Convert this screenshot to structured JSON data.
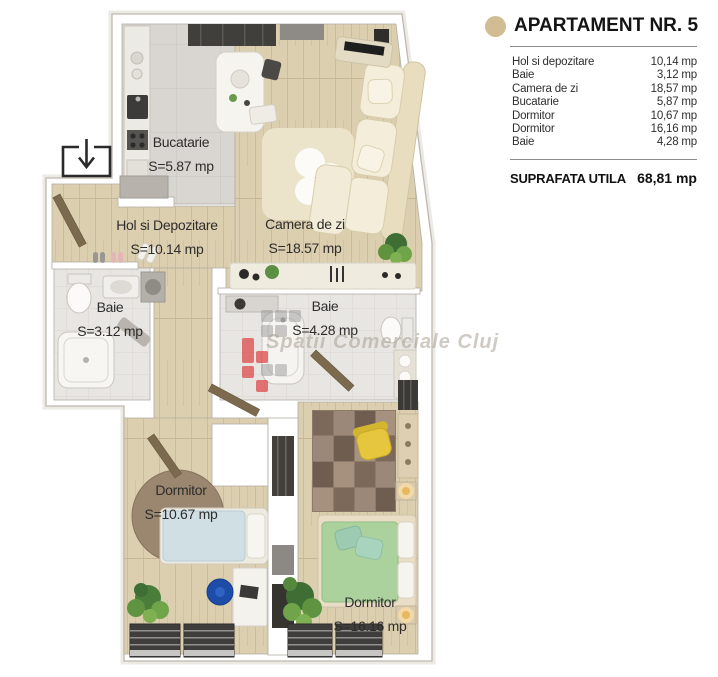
{
  "panel": {
    "title": "APARTAMENT NR. 5",
    "rooms": [
      {
        "name": "Hol si depozitare",
        "area": "10,14 mp"
      },
      {
        "name": "Baie",
        "area": "3,12 mp"
      },
      {
        "name": "Camera de zi",
        "area": "18,57 mp"
      },
      {
        "name": "Bucatarie",
        "area": "5,87 mp"
      },
      {
        "name": "Dormitor",
        "area": "10,67 mp"
      },
      {
        "name": "Dormitor",
        "area": "16,16 mp"
      },
      {
        "name": "Baie",
        "area": "4,28 mp"
      }
    ],
    "total_label": "SUPRAFATA UTILA",
    "total_value": "68,81 mp"
  },
  "plan": {
    "labels": [
      {
        "room": "Bucatarie",
        "area": "S=5.87 mp"
      },
      {
        "room": "Hol si Depozitare",
        "area": "S=10.14 mp"
      },
      {
        "room": "Camera de zi",
        "area": "S=18.57 mp"
      },
      {
        "room": "Baie",
        "area": "S=3.12 mp"
      },
      {
        "room": "Baie",
        "area": "S=4.28 mp"
      },
      {
        "room": "Dormitor",
        "area": "S=10.67 mp"
      },
      {
        "room": "Dormitor",
        "area": "S=16.16 mp"
      }
    ],
    "watermark_text": "Spatii Comerciale Cluj",
    "entrance_icon": "entrance-down-arrow"
  },
  "colors": {
    "bullet": "#d2bc93",
    "watermark_red": "#dd4a4a",
    "watermark_gray": "#9a9a9a"
  }
}
